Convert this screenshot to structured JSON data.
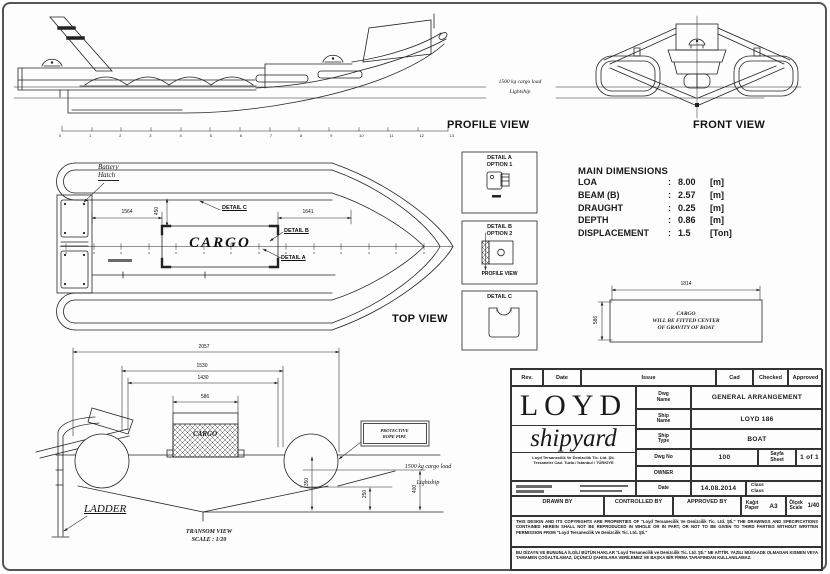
{
  "colors": {
    "paper": "#fdfdfd",
    "line": "#222222",
    "frame": "#555555"
  },
  "views": {
    "profile": "PROFILE VIEW",
    "front": "FRONT VIEW",
    "top": "TOP VIEW",
    "transom_title": "TRANSOM VIEW",
    "transom_scale": "SCALE : 1/20"
  },
  "annotations": {
    "battery_l1": "Battery",
    "battery_l2": "Hatch",
    "cargo_top": "CARGO",
    "cargo_transom": "CARGO",
    "detail_a": "DETAIL A",
    "detail_b": "DETAIL B",
    "detail_c": "DETAIL C",
    "ladder": "LADDER",
    "protective_l1": "PROTECTIVE",
    "protective_l2": "ROPE PIPE",
    "load_note": "1500 kg cargo load",
    "lightship": "Lightship"
  },
  "dimensions": {
    "d1564": "1564",
    "d1641": "1641",
    "d450": "450",
    "d2057": "2057",
    "d1530": "1530",
    "d1430": "1430",
    "d586": "586",
    "d350": "350",
    "d250": "250",
    "d400": "400",
    "d1814": "1814",
    "d586_h": "586"
  },
  "ruler_numbers": [
    "0",
    "1",
    "2",
    "3",
    "4",
    "5",
    "6",
    "7",
    "8",
    "9",
    "10",
    "11",
    "12",
    "13"
  ],
  "detail_boxes": {
    "a_title": "DETAIL A",
    "a_sub": "OPTION 1",
    "b_title": "DETAIL B",
    "b_sub": "OPTION 2",
    "b_footer": "PROFILE VIEW",
    "c_title": "DETAIL C"
  },
  "main_dimensions": {
    "title": "MAIN DIMENSIONS",
    "rows": [
      {
        "label": "LOA",
        "sep": ":",
        "value": "8.00",
        "unit": "[m]"
      },
      {
        "label": "BEAM (B)",
        "sep": ":",
        "value": "2.57",
        "unit": "[m]"
      },
      {
        "label": "DRAUGHT",
        "sep": ":",
        "value": "0.25",
        "unit": "[m]"
      },
      {
        "label": "DEPTH",
        "sep": ":",
        "value": "0.86",
        "unit": "[m]"
      },
      {
        "label": "DISPLACEMENT",
        "sep": ":",
        "value": "1.5",
        "unit": "[Ton]"
      }
    ]
  },
  "cargo_note": {
    "l1": "CARGO",
    "l2": "WILL BE FITTED CENTER",
    "l3": "OF GRAVITY OF BOAT"
  },
  "title_block": {
    "header": {
      "rev": "Rev.",
      "date": "Date",
      "issue": "Issue",
      "cad": "Cad",
      "checked": "Checked",
      "approved": "Approved"
    },
    "company": {
      "name_top": "LOYD",
      "name_bottom": "shipyard",
      "address_l1": "Loyd Tersanecilik Ve Denizcilik Tic. Ltd. Şti.",
      "address_l2": "Tersaneler Cad. Tuzla / İstanbul / TÜRKİYE"
    },
    "dwg_name_l1": "Dwg",
    "dwg_name_l2": "Name",
    "dwg_name_value": "GENERAL ARRANGEMENT",
    "ship_name_l1": "Ship",
    "ship_name_l2": "Name",
    "ship_name_value": "LOYD 186",
    "ship_type_l1": "Ship",
    "ship_type_l2": "Type",
    "ship_type_value": "BOAT",
    "dwg_no_label": "Dwg No",
    "dwg_no_value": "100",
    "sheet_l1": "Sayfa",
    "sheet_l2": "Sheet",
    "sheet_value": "1 of 1",
    "owner_label": "OWNER",
    "date_label": "Date",
    "date_value": "14.08.2014",
    "class_l1": "Class",
    "class_l2": "Class",
    "drawn_by": "DRAWN BY",
    "controlled_by": "CONTROLLED BY",
    "approved_by": "APPROVED BY",
    "paper_l1": "Kağıt",
    "paper_l2": "Paper",
    "paper_value": "A3",
    "scale_l1": "Ölçek",
    "scale_l2": "Scale",
    "scale_value": "1/40",
    "legal_en": "THIS DESIGN AND ITS COPYRIGHTS ARE PROPERTIES OF \"Loyd Tersanecilik Ve Denizcilik Tic. Ltd. Şti.\" THE DRAWINGS AND SPECIFICATIONS CONTAINED HEREIN SHALL NOT BE REPRODUCED IN WHOLE OR IN PART, OR NOT TO BE GIVEN TO THIRD PARTIES WITHOUT WRITTEN PERMISSION FROM \"Loyd Tersanecilik Ve Denizcilik Tic. Ltd. Şti.\"",
    "legal_tr": "BU DİZAYN VE BUNUNLA İLGİLİ BÜTÜN HAKLAR \"Loyd Tersanecilik ve Denizcilik Tic. Ltd. Şti.\" NE AİTTİR. YAZILI MÜSAADE OLMADAN KISMEN VEYA TAMAMEN ÇOĞALTILAMAZ, ÜÇÜNCÜ ŞAHISLARA VERİLEMEZ VE BAŞKA BİR FİRMA TARAFINDAN KULLANILAMAZ."
  }
}
